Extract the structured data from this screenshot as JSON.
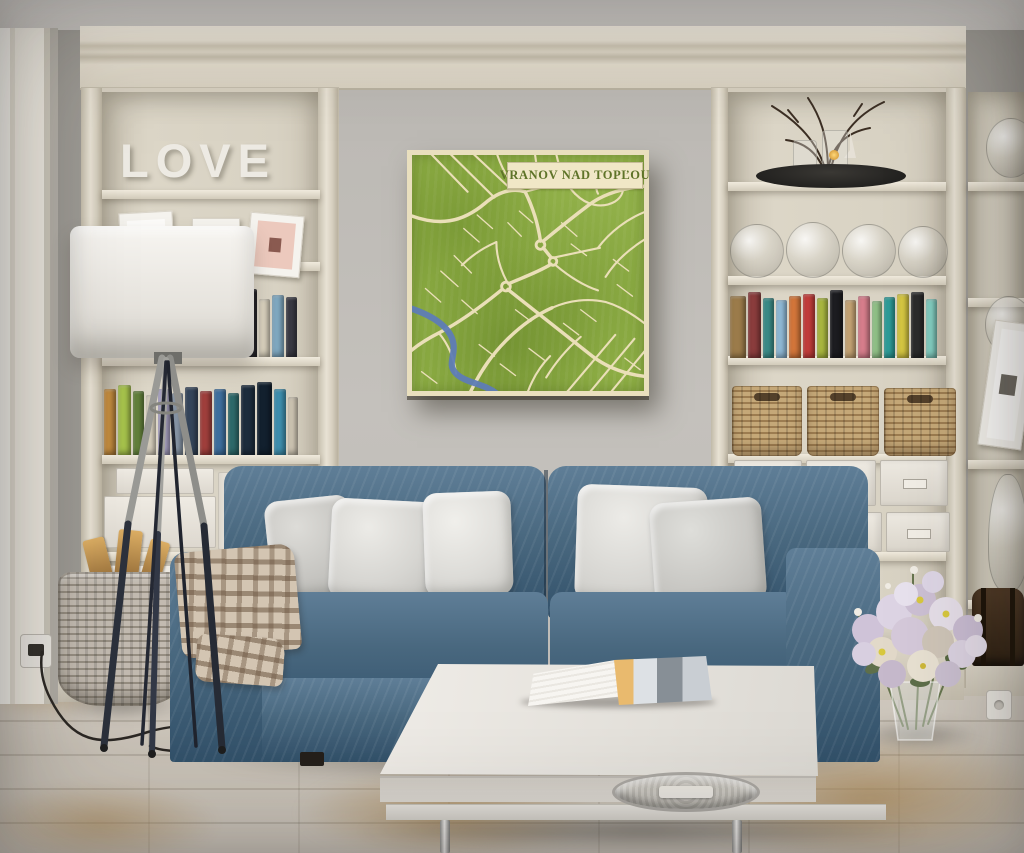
{
  "scene": {
    "type": "living room interior photograph",
    "wall_art_title": "VRANOV NAD TOPĽOU",
    "shelf_decor_word": "LOVE"
  },
  "palette": {
    "wall": "#a6a39d",
    "map-green": "#8dad44",
    "map-road": "#eadfb8",
    "map-river": "#5e7cb6",
    "map-banner": "#f0e7c6",
    "map-title": "#5e7328",
    "map-frame": "#e9dfbe",
    "sofa": "#49687f",
    "sofa-dark": "#32516a",
    "sofa-hi": "#5f7e97",
    "throw": "#d3c5b2"
  },
  "map_art": {
    "title": "VRANOV NAD TOPĽOU"
  },
  "left_bookcase": {
    "decor_word": "LOVE",
    "picture_frames": 3,
    "books_top": [
      {
        "c": "#8a4a42",
        "h": 66,
        "w": 13
      },
      {
        "c": "#46648c",
        "h": 60,
        "w": 11
      },
      {
        "c": "#37807c",
        "h": 63,
        "w": 12
      },
      {
        "c": "#d9d3c5",
        "h": 57,
        "w": 10
      },
      {
        "c": "#a84a4e",
        "h": 64,
        "w": 13
      },
      {
        "c": "#6b4f7c",
        "h": 58,
        "w": 11
      },
      {
        "c": "#2f2f38",
        "h": 66,
        "w": 14
      },
      {
        "c": "#97b44d",
        "h": 61,
        "w": 12
      },
      {
        "c": "#ccdc8e",
        "h": 55,
        "w": 10
      },
      {
        "c": "#48783e",
        "h": 63,
        "w": 12
      },
      {
        "c": "#23232a",
        "h": 68,
        "w": 15
      },
      {
        "c": "#dcd4c0",
        "h": 58,
        "w": 11
      },
      {
        "c": "#7fa8c0",
        "h": 62,
        "w": 12
      },
      {
        "c": "#3a3a44",
        "h": 60,
        "w": 11
      }
    ],
    "books_bottom": [
      {
        "c": "#c08a3e",
        "h": 66,
        "w": 12
      },
      {
        "c": "#a6c24c",
        "h": 70,
        "w": 13
      },
      {
        "c": "#64823c",
        "h": 64,
        "w": 11
      },
      {
        "c": "#d8d0be",
        "h": 60,
        "w": 10
      },
      {
        "c": "#a9a2c4",
        "h": 66,
        "w": 12
      },
      {
        "c": "#8795a5",
        "h": 62,
        "w": 11
      },
      {
        "c": "#35455a",
        "h": 68,
        "w": 13
      },
      {
        "c": "#a03f3c",
        "h": 64,
        "w": 12
      },
      {
        "c": "#3e6f9e",
        "h": 66,
        "w": 12
      },
      {
        "c": "#2e6a6b",
        "h": 62,
        "w": 11
      },
      {
        "c": "#1d2c3c",
        "h": 70,
        "w": 14
      },
      {
        "c": "#12202e",
        "h": 73,
        "w": 15
      },
      {
        "c": "#3e8fae",
        "h": 66,
        "w": 12
      },
      {
        "c": "#cfc6b4",
        "h": 58,
        "w": 10
      }
    ],
    "magazine_files": [
      {
        "w": 32,
        "h": 78
      },
      {
        "w": 32,
        "h": 74
      },
      {
        "w": 30,
        "h": 76
      }
    ]
  },
  "right_bookcase": {
    "glass_vases": [
      {
        "w": 54,
        "h": 54
      },
      {
        "w": 54,
        "h": 56
      },
      {
        "w": 54,
        "h": 54
      },
      {
        "w": 50,
        "h": 52
      }
    ],
    "books": [
      {
        "c": "#9b7b4a",
        "h": 62,
        "w": 16
      },
      {
        "c": "#8a3c3c",
        "h": 66,
        "w": 13
      },
      {
        "c": "#3b8c88",
        "h": 60,
        "w": 11
      },
      {
        "c": "#8fb9d6",
        "h": 58,
        "w": 11
      },
      {
        "c": "#d3763a",
        "h": 62,
        "w": 12
      },
      {
        "c": "#c23d3a",
        "h": 64,
        "w": 12
      },
      {
        "c": "#aab83f",
        "h": 60,
        "w": 11
      },
      {
        "c": "#1c1c20",
        "h": 68,
        "w": 13
      },
      {
        "c": "#c6a474",
        "h": 58,
        "w": 11
      },
      {
        "c": "#d77e8c",
        "h": 62,
        "w": 12
      },
      {
        "c": "#93c489",
        "h": 57,
        "w": 10
      },
      {
        "c": "#2f9e9a",
        "h": 61,
        "w": 11
      },
      {
        "c": "#d6c742",
        "h": 64,
        "w": 12
      },
      {
        "c": "#2c2c2c",
        "h": 66,
        "w": 13
      },
      {
        "c": "#83cfc2",
        "h": 59,
        "w": 11
      }
    ],
    "wicker_baskets": [
      {
        "w": 70,
        "h": 70
      },
      {
        "w": 72,
        "h": 70
      },
      {
        "w": 72,
        "h": 68
      }
    ],
    "label_boxes_row1": [
      {
        "w": 68,
        "h": 46
      },
      {
        "w": 70,
        "h": 46
      },
      {
        "w": 68,
        "h": 46
      }
    ],
    "label_boxes_row2": [
      {
        "w": 66,
        "h": 40
      },
      {
        "w": 68,
        "h": 40
      },
      {
        "w": 64,
        "h": 40
      }
    ]
  },
  "furniture": {
    "sofa_pillows": 5,
    "coffee_table_items": [
      "open book",
      "round metal tray"
    ]
  }
}
